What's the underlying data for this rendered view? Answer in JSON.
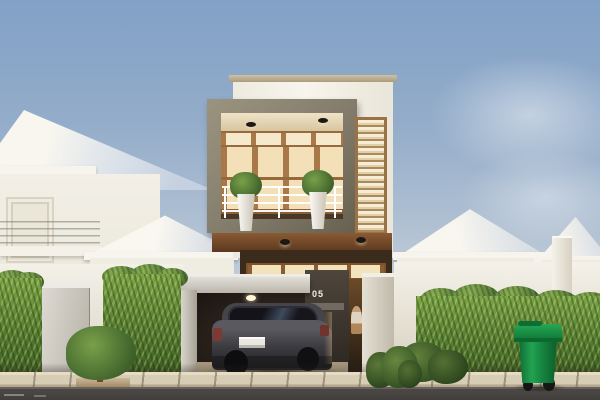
{
  "scene": {
    "type": "architectural 3D exterior rendering",
    "description": "Narrow modern two-storey house with a cantilevered grey concrete box, timber-framed glass balcony, louvered side window and a carport with a parked dark SUV, flanked by white gable- and hip-roof neighbour houses, trimmed hedges, a small round shrub, and a green wheelie bin on the pavement under a soft blue sky.",
    "lighting": "warm interior glow at dusk"
  },
  "modern_house": {
    "number": "05",
    "plaque_text": "ALPHA THE HOME"
  },
  "objects": {
    "car": "dark grey SUV parked in carport",
    "bin": "green wheelie bin on pavement",
    "planters": "two white tapered balcony planters with green plants",
    "person": "small figure standing at the entrance",
    "tree": "round clipped shrub on the pavement",
    "hedges": "green hedges along the front boundary walls"
  },
  "colors": {
    "sky_top": "#81a1c6",
    "sky_horizon": "#e3e4e2",
    "facade_white": "#f2efe7",
    "concrete_frame": "#8a8474",
    "timber": "#ab7c4e",
    "glass_glow": "#f7e9c8",
    "dark_cladding": "#3a2f26",
    "hedge_green": "#5d8038",
    "bin_green": "#1d9147",
    "car_grey": "#3c3b40",
    "road": "#4c4946",
    "pavement": "#d9cfb7"
  }
}
